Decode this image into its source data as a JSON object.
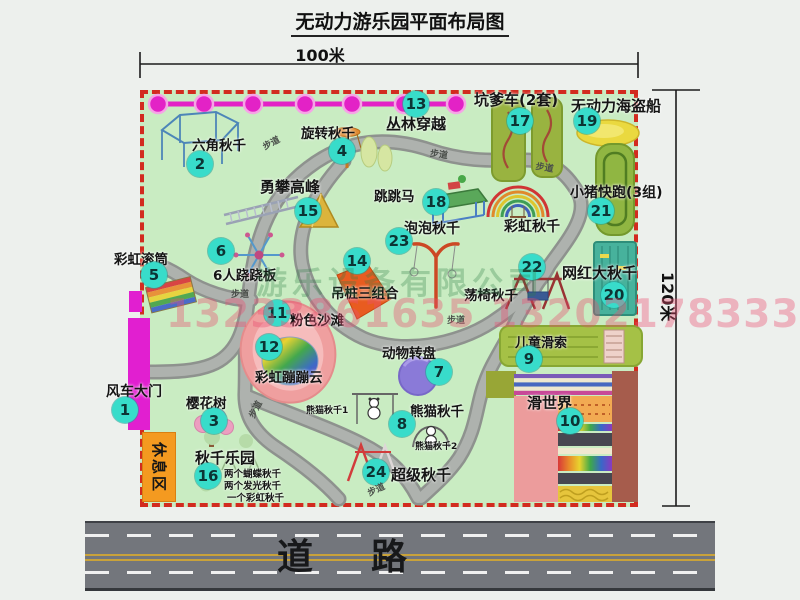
{
  "title": "无动力游乐园平面布局图",
  "dimensions": {
    "width_label": "100米",
    "height_label": "120米"
  },
  "road": {
    "label": "道路"
  },
  "watermark": {
    "company": "游乐设备有限公司",
    "phone": "13233861635 13202178333"
  },
  "rest_area": {
    "label": "休息区"
  },
  "colors": {
    "border_red": "#d22b1f",
    "map_green": "#c9ecc2",
    "badge_teal": "#38dcca",
    "chain_magenta": "#e322c6",
    "gate_magenta": "#e11fd0",
    "road_gray": "#73767c",
    "rest_orange": "#f49a20"
  },
  "map": {
    "path_label_text": "步道",
    "markers": [
      {
        "num": 1,
        "label": "风车大门",
        "lx": 106,
        "ly": 381,
        "nx": 112,
        "ny": 397,
        "ls": 14
      },
      {
        "num": 2,
        "label": "六角秋千",
        "lx": 192,
        "ly": 134,
        "nx": 187,
        "ny": 151
      },
      {
        "num": 3,
        "label": "樱花树",
        "lx": 186,
        "ly": 392,
        "nx": 201,
        "ny": 408
      },
      {
        "num": 4,
        "label": "旋转秋千",
        "lx": 301,
        "ly": 122,
        "nx": 329,
        "ny": 138
      },
      {
        "num": 5,
        "label": "彩虹滚筒",
        "lx": 114,
        "ly": 248,
        "nx": 141,
        "ny": 262
      },
      {
        "num": 6,
        "label": "6人跷跷板",
        "lx": 213,
        "ly": 264,
        "nx": 208,
        "ny": 238
      },
      {
        "num": 7,
        "label": "动物转盘",
        "lx": 382,
        "ly": 342,
        "nx": 426,
        "ny": 359
      },
      {
        "num": 8,
        "label": "熊猫秋千",
        "lx": 410,
        "ly": 400,
        "nx": 389,
        "ny": 411
      },
      {
        "num": 9,
        "label": "儿童滑索",
        "lx": 515,
        "ly": 332,
        "nx": 516,
        "ny": 346,
        "ls": 13
      },
      {
        "num": 10,
        "label": "滑世界",
        "lx": 527,
        "ly": 392,
        "nx": 557,
        "ny": 408,
        "ls": 15
      },
      {
        "num": 11,
        "label": "粉色沙滩",
        "lx": 290,
        "ly": 309,
        "nx": 264,
        "ny": 300
      },
      {
        "num": 12,
        "label": "彩虹蹦蹦云",
        "lx": 255,
        "ly": 366,
        "nx": 256,
        "ny": 334
      },
      {
        "num": 13,
        "label": "丛林穿越",
        "lx": 386,
        "ly": 113,
        "nx": 403,
        "ny": 91,
        "ls": 15
      },
      {
        "num": 14,
        "label": "吊桩三组合",
        "lx": 331,
        "ly": 282,
        "nx": 344,
        "ny": 248
      },
      {
        "num": 15,
        "label": "勇攀高峰",
        "lx": 260,
        "ly": 176,
        "nx": 295,
        "ny": 198,
        "ls": 15
      },
      {
        "num": 16,
        "label": "秋千乐园",
        "lx": 195,
        "ly": 447,
        "nx": 195,
        "ny": 463,
        "ls": 15
      },
      {
        "num": 17,
        "label": "坑爹车(2套)",
        "lx": 474,
        "ly": 89,
        "nx": 507,
        "ny": 108,
        "ls": 15
      },
      {
        "num": 18,
        "label": "跳跳马",
        "lx": 374,
        "ly": 185,
        "nx": 423,
        "ny": 189
      },
      {
        "num": 19,
        "label": "无动力海盗船",
        "lx": 571,
        "ly": 95,
        "nx": 574,
        "ny": 108,
        "ls": 15
      },
      {
        "num": 20,
        "label": "网红大秋千",
        "lx": 562,
        "ly": 262,
        "nx": 601,
        "ny": 282,
        "ls": 15
      },
      {
        "num": 21,
        "label": "小猪快跑(3组)",
        "lx": 570,
        "ly": 182,
        "nx": 588,
        "ny": 198,
        "ls": 14
      },
      {
        "num": 22,
        "label": "荡椅秋千",
        "lx": 464,
        "ly": 284,
        "nx": 519,
        "ny": 254
      },
      {
        "num": 23,
        "label": "泡泡秋千",
        "lx": 404,
        "ly": 218,
        "nx": 386,
        "ny": 228,
        "ls": 14
      },
      {
        "num": 24,
        "label": "超级秋千",
        "lx": 391,
        "ly": 464,
        "nx": 363,
        "ny": 459,
        "ls": 15
      }
    ],
    "extra_labels": [
      {
        "text": "彩虹秋千",
        "x": 504,
        "y": 216,
        "s": 14,
        "name": "label-rainbow-swing"
      },
      {
        "text": "熊猫秋千1",
        "x": 306,
        "y": 403,
        "s": 9,
        "name": "label-panda-swing-1"
      },
      {
        "text": "熊猫秋千2",
        "x": 415,
        "y": 439,
        "s": 9,
        "name": "label-panda-swing-2"
      },
      {
        "text": "两个蝴蝶秋千",
        "x": 224,
        "y": 466,
        "s": 9.5,
        "name": "label-swing-park-note-1"
      },
      {
        "text": "两个发光秋千",
        "x": 224,
        "y": 478,
        "s": 9.5,
        "name": "label-swing-park-note-2"
      },
      {
        "text": "一个彩虹秋千",
        "x": 227,
        "y": 490,
        "s": 9.5,
        "name": "label-swing-park-note-3"
      }
    ],
    "path_labels": [
      {
        "x": 260,
        "y": 141,
        "rot": -28
      },
      {
        "x": 431,
        "y": 146,
        "rot": 8
      },
      {
        "x": 537,
        "y": 159,
        "rot": 10
      },
      {
        "x": 231,
        "y": 287,
        "rot": 0
      },
      {
        "x": 447,
        "y": 313,
        "rot": 0
      },
      {
        "x": 245,
        "y": 414,
        "rot": -62
      },
      {
        "x": 365,
        "y": 487,
        "rot": -25
      }
    ]
  }
}
